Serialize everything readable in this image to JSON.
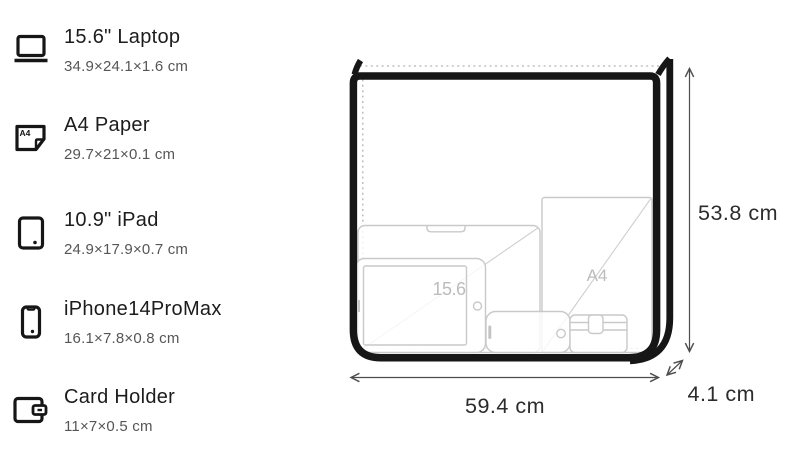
{
  "legend": {
    "items": [
      {
        "icon": "laptop-icon",
        "title": "15.6\" Laptop",
        "dims": "34.9×24.1×1.6 cm"
      },
      {
        "icon": "a4-paper-icon",
        "title": "A4 Paper",
        "dims": "29.7×21×0.1 cm",
        "icon_text": "A4"
      },
      {
        "icon": "ipad-icon",
        "title": "10.9\" iPad",
        "dims": "24.9×17.9×0.7 cm"
      },
      {
        "icon": "iphone-icon",
        "title": "iPhone14ProMax",
        "dims": "16.1×7.8×0.8 cm"
      },
      {
        "icon": "card-holder-icon",
        "title": "Card Holder",
        "dims": "11×7×0.5 cm"
      }
    ]
  },
  "diagram": {
    "height_label": "53.8 cm",
    "width_label": "59.4 cm",
    "depth_label": "4.1 cm",
    "laptop_label": "15.6",
    "a4_label": "A4"
  },
  "colors": {
    "bag_outline": "#161616",
    "item_line": "#c9c9c9",
    "item_label": "#bcbcbc",
    "dimension_text": "#2c2c2c",
    "arrow": "#4d4d4d",
    "dashed_line": "#b5b5b5"
  }
}
